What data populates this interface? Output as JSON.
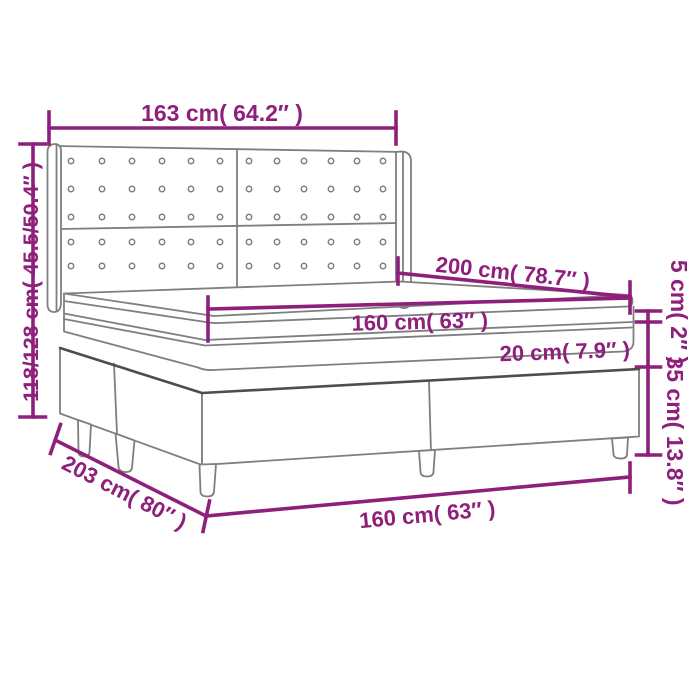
{
  "diagram": {
    "type": "box-spring-bed-dimension-diagram",
    "colors": {
      "dimension_accent": "#8e1f7a",
      "drawing_line": "#7f7f7f",
      "drawing_line_dark": "#4d4d4d",
      "background": "#ffffff"
    },
    "labels": {
      "headboard_width": "163 cm( 64.2″ )",
      "total_height": "118/128 cm( 45.5/50.4″ )",
      "bed_length": "200 cm( 78.7″ )",
      "mattress_width": "160 cm( 63″ )",
      "mattress_height": "20 cm( 7.9″ )",
      "topper_height": "5 cm( 2″ )",
      "base_height": "35 cm( 13.8″ )",
      "base_length": "203 cm( 80″ )",
      "base_width": "160 cm( 63″ )"
    }
  }
}
